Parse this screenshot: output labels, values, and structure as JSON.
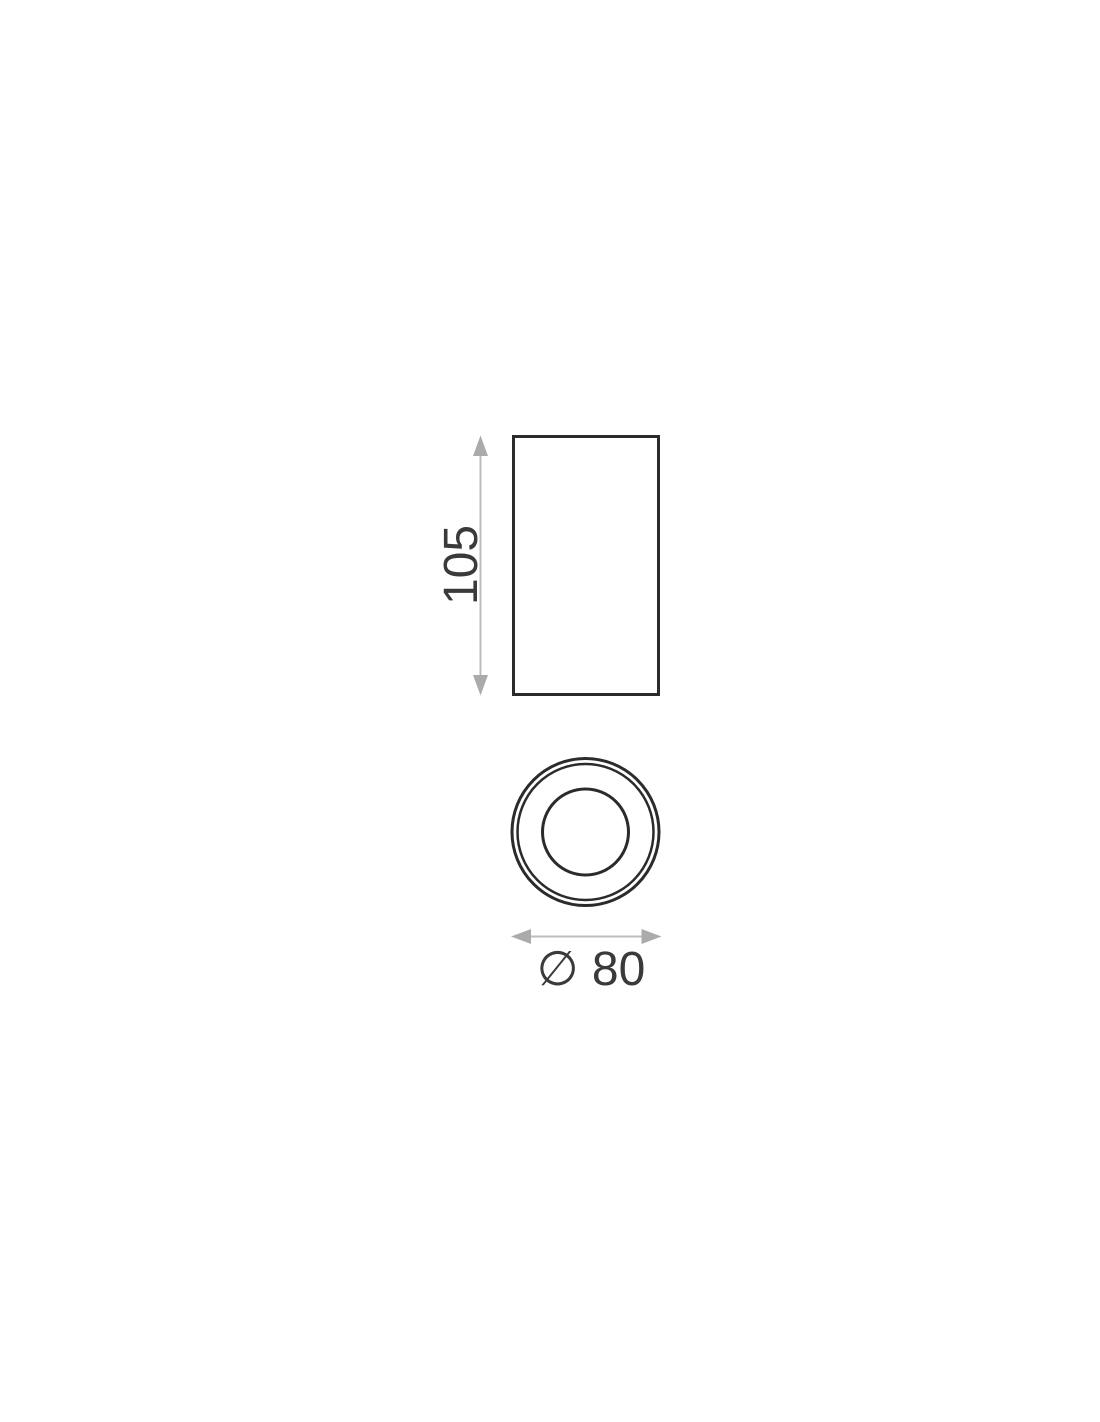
{
  "diagram": {
    "kind": "technical-drawing",
    "subject": "cylindrical ceiling spotlight — dimension views",
    "views": {
      "side_view": {
        "shape": "rectangle"
      },
      "top_view": {
        "shape": "concentric-circles",
        "circle_count": 3
      }
    },
    "dimensions": {
      "height": {
        "label": "105"
      },
      "diameter": {
        "label": "∅ 80"
      }
    },
    "colors": {
      "outline": "#2b2b2b",
      "dimension_line": "#bdbdbd",
      "dimension_arrow": "#ababab",
      "dimension_text": "#3a3a3a",
      "background": "#ffffff"
    }
  }
}
